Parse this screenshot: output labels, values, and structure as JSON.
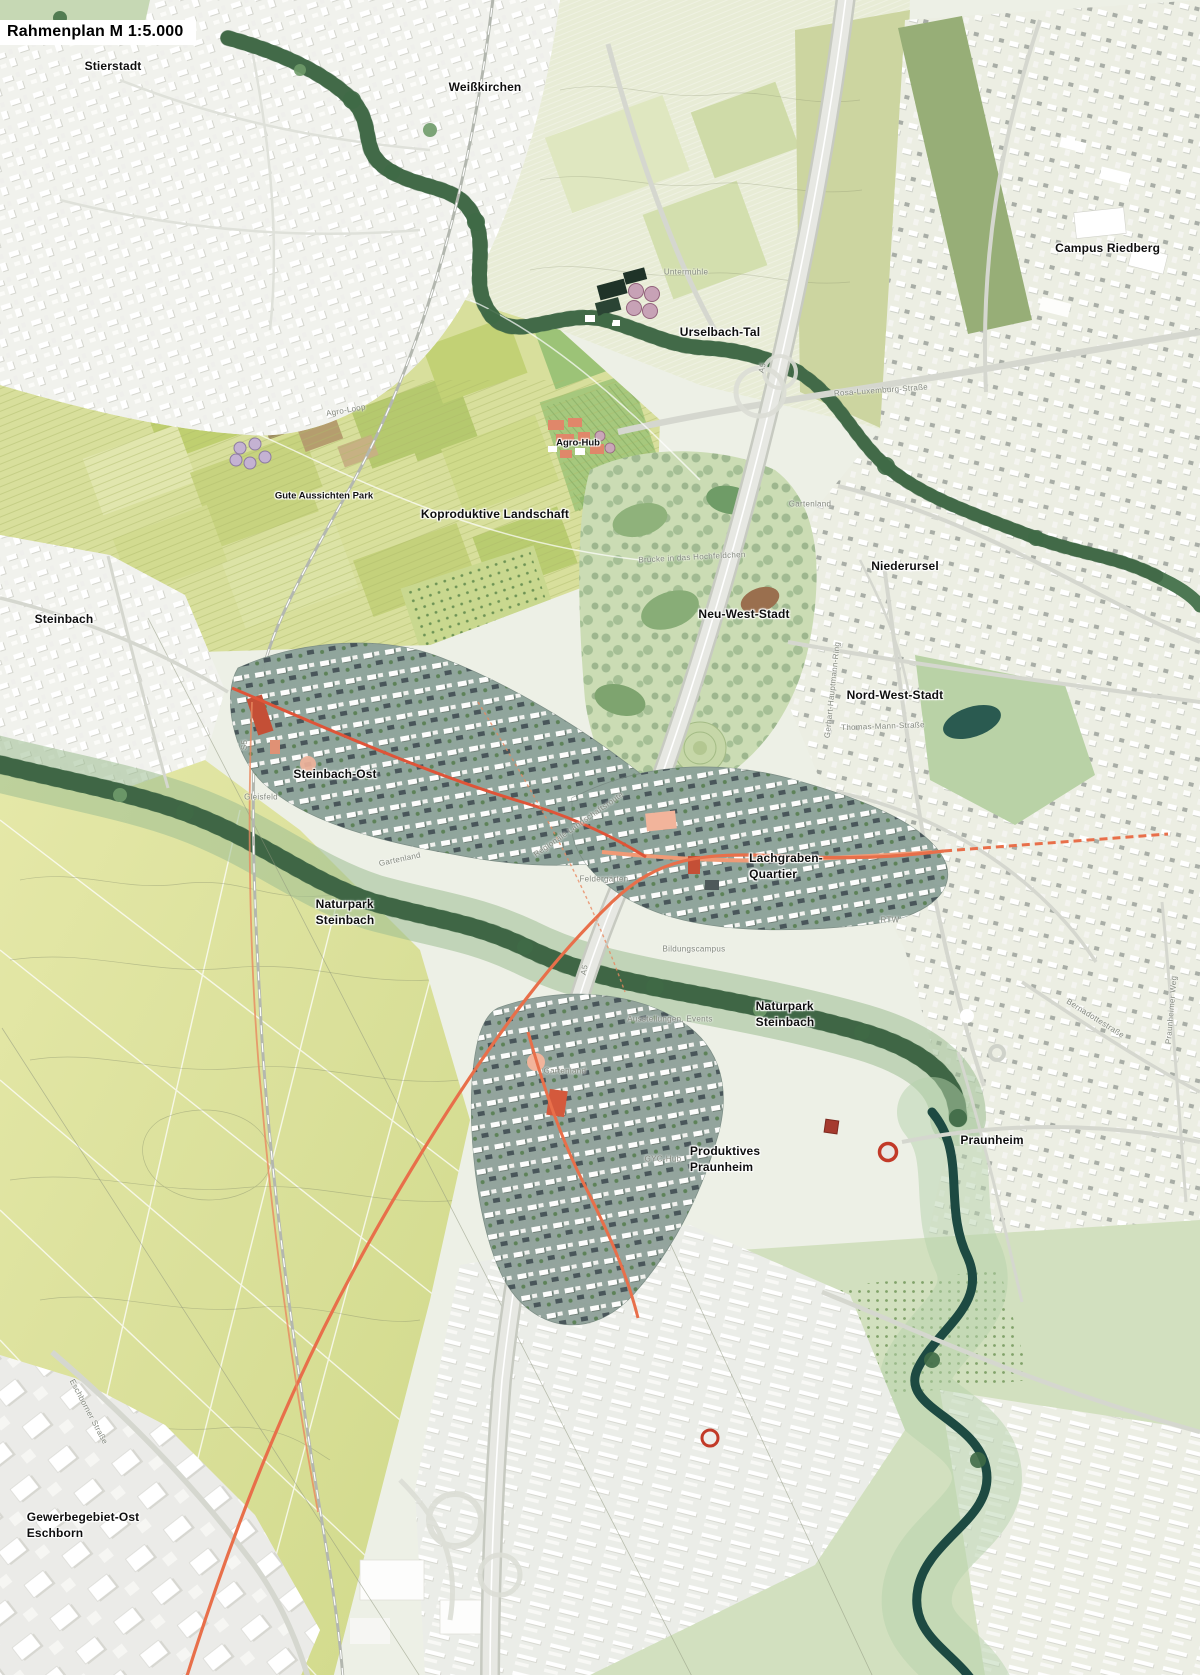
{
  "title": {
    "text": "Rahmenplan M 1:5.000"
  },
  "palette": {
    "new_quarter_base": "#8ea39a",
    "rtw_orange": "#e86f4a",
    "accent_red": "#c44f36",
    "plaza_salmon": "#f2b49b",
    "naturpark_green": "#47724d",
    "water_dark": "#1d4a42",
    "field_yellow_green": "#d8df9c",
    "urban_light": "#f1f2ed",
    "urban_right": "#eceee3",
    "label_black": "#0e0e0e",
    "label_gray": "#83887e",
    "title_bg": "#ffffff"
  },
  "map_labels": [
    {
      "id": "stierstadt",
      "type": "place",
      "lines": [
        "Stierstadt"
      ],
      "x": 9.42,
      "y": 4.0
    },
    {
      "id": "weisskirchen",
      "type": "place",
      "lines": [
        "Weißkirchen"
      ],
      "x": 40.42,
      "y": 5.25
    },
    {
      "id": "campus-riedberg",
      "type": "place",
      "lines": [
        "Campus Riedberg"
      ],
      "x": 92.3,
      "y": 14.87
    },
    {
      "id": "urselbach-tal",
      "type": "place",
      "lines": [
        "Urselbach-Tal"
      ],
      "x": 60.0,
      "y": 19.88
    },
    {
      "id": "agro-hub",
      "type": "place-sm",
      "lines": [
        "Agro-Hub"
      ],
      "x": 48.17,
      "y": 26.51
    },
    {
      "id": "gute-aussichten-park",
      "type": "place-sm",
      "lines": [
        "Gute Aussichten Park"
      ],
      "x": 27.0,
      "y": 29.67
    },
    {
      "id": "koproduktive-landschaft",
      "type": "place",
      "lines": [
        "Koproduktive Landschaft"
      ],
      "x": 41.25,
      "y": 30.75
    },
    {
      "id": "niederursel",
      "type": "place",
      "lines": [
        "Niederursel"
      ],
      "x": 75.42,
      "y": 33.85
    },
    {
      "id": "neu-west-stadt",
      "type": "place",
      "lines": [
        "Neu-West-Stadt"
      ],
      "x": 62.0,
      "y": 36.72
    },
    {
      "id": "steinbach",
      "type": "place",
      "lines": [
        "Steinbach"
      ],
      "x": 5.33,
      "y": 37.01
    },
    {
      "id": "nord-west-stadt",
      "type": "place",
      "lines": [
        "Nord-West-Stadt"
      ],
      "x": 74.58,
      "y": 41.55
    },
    {
      "id": "steinbach-ost",
      "type": "place",
      "lines": [
        "Steinbach-Ost"
      ],
      "x": 27.92,
      "y": 46.27
    },
    {
      "id": "lachgraben-quartier",
      "type": "place",
      "lines": [
        "Lachgraben-",
        "Quartier"
      ],
      "x": 65.5,
      "y": 51.76
    },
    {
      "id": "naturpark-steinbach-west",
      "type": "place",
      "lines": [
        "Naturpark",
        "Steinbach"
      ],
      "x": 28.75,
      "y": 54.51
    },
    {
      "id": "naturpark-steinbach-ost",
      "type": "place",
      "lines": [
        "Naturpark",
        "Steinbach"
      ],
      "x": 65.42,
      "y": 60.6
    },
    {
      "id": "praunheim",
      "type": "place",
      "lines": [
        "Praunheim"
      ],
      "x": 82.67,
      "y": 68.12
    },
    {
      "id": "produktives-praunheim",
      "type": "place",
      "lines": [
        "Produktives",
        "Praunheim"
      ],
      "x": 60.42,
      "y": 69.25
    },
    {
      "id": "gewerbegebiet-ost-eschborn",
      "type": "place",
      "lines": [
        "Gewerbegebiet-Ost",
        "Eschborn"
      ],
      "x": 6.92,
      "y": 91.1
    },
    {
      "id": "untermuehle",
      "type": "road",
      "lines": [
        "Untermühle"
      ],
      "x": 57.17,
      "y": 16.3
    },
    {
      "id": "rosa-luxemburg-strasse",
      "type": "road",
      "lines": [
        "Rosa-Luxemburg-Straße"
      ],
      "x": 73.42,
      "y": 23.34,
      "rot": -4
    },
    {
      "id": "agro-loop",
      "type": "road",
      "lines": [
        "Agro-Loop"
      ],
      "x": 28.83,
      "y": 24.54,
      "rot": -10
    },
    {
      "id": "gartenland-nord",
      "type": "road",
      "lines": [
        "Gartenland"
      ],
      "x": 67.5,
      "y": 30.15
    },
    {
      "id": "bruecke-hochfeldchen",
      "type": "road",
      "lines": [
        "Brücke in das Hochfeldchen"
      ],
      "x": 57.67,
      "y": 33.31,
      "rot": -3
    },
    {
      "id": "a5-nord",
      "type": "road",
      "lines": [
        "A5"
      ],
      "x": 63.58,
      "y": 21.97,
      "rot": -77
    },
    {
      "id": "s5-bahn",
      "type": "road",
      "lines": [
        "S5"
      ],
      "x": 20.42,
      "y": 44.48,
      "rot": -88
    },
    {
      "id": "thomas-mann-strasse",
      "type": "road",
      "lines": [
        "Thomas-Mann-Straße"
      ],
      "x": 73.58,
      "y": 43.4,
      "rot": -2
    },
    {
      "id": "gerhart-hauptmann-ring",
      "type": "road",
      "lines": [
        "Gerhart-Hauptmann-Ring"
      ],
      "x": 69.42,
      "y": 41.19,
      "rot": -84
    },
    {
      "id": "gleisfeld",
      "type": "road",
      "lines": [
        "Gleisfeld"
      ],
      "x": 21.75,
      "y": 47.64
    },
    {
      "id": "gartenland-mitte",
      "type": "road",
      "lines": [
        "Gartenland"
      ],
      "x": 33.33,
      "y": 51.34,
      "rot": -12
    },
    {
      "id": "regionale-landschaftsroute",
      "type": "road",
      "lines": [
        "Regionale Landschaftsroute"
      ],
      "x": 48.25,
      "y": 49.25,
      "rot": -35
    },
    {
      "id": "feldergaerten",
      "type": "road",
      "lines": [
        "Feldergärten"
      ],
      "x": 50.33,
      "y": 52.54
    },
    {
      "id": "rtw",
      "type": "road",
      "lines": [
        "RTW"
      ],
      "x": 74.17,
      "y": 54.99
    },
    {
      "id": "bildungscampus",
      "type": "road",
      "lines": [
        "Bildungscampus"
      ],
      "x": 57.83,
      "y": 56.72
    },
    {
      "id": "ausstellungen-events",
      "type": "road",
      "lines": [
        "Ausstellungen, Events"
      ],
      "x": 55.83,
      "y": 60.9
    },
    {
      "id": "gyc-hub",
      "type": "road",
      "lines": [
        "GYC-Hub"
      ],
      "x": 55.25,
      "y": 69.25
    },
    {
      "id": "praunheimer-weg",
      "type": "road",
      "lines": [
        "Praunheimer Weg"
      ],
      "x": 97.67,
      "y": 60.3,
      "rot": -85
    },
    {
      "id": "bernadottestrasse",
      "type": "road",
      "lines": [
        "Bernadottestraße"
      ],
      "x": 91.25,
      "y": 60.84,
      "rot": 32
    },
    {
      "id": "gartenland-sued",
      "type": "road",
      "lines": [
        "Gartenland"
      ],
      "x": 47.08,
      "y": 64.0
    },
    {
      "id": "eschborner-strasse",
      "type": "road",
      "lines": [
        "Eschborner Straße"
      ],
      "x": 7.33,
      "y": 84.3,
      "rot": 62
    },
    {
      "id": "a5-sued",
      "type": "road",
      "lines": [
        "A5"
      ],
      "x": 48.75,
      "y": 57.91,
      "rot": -78
    }
  ]
}
